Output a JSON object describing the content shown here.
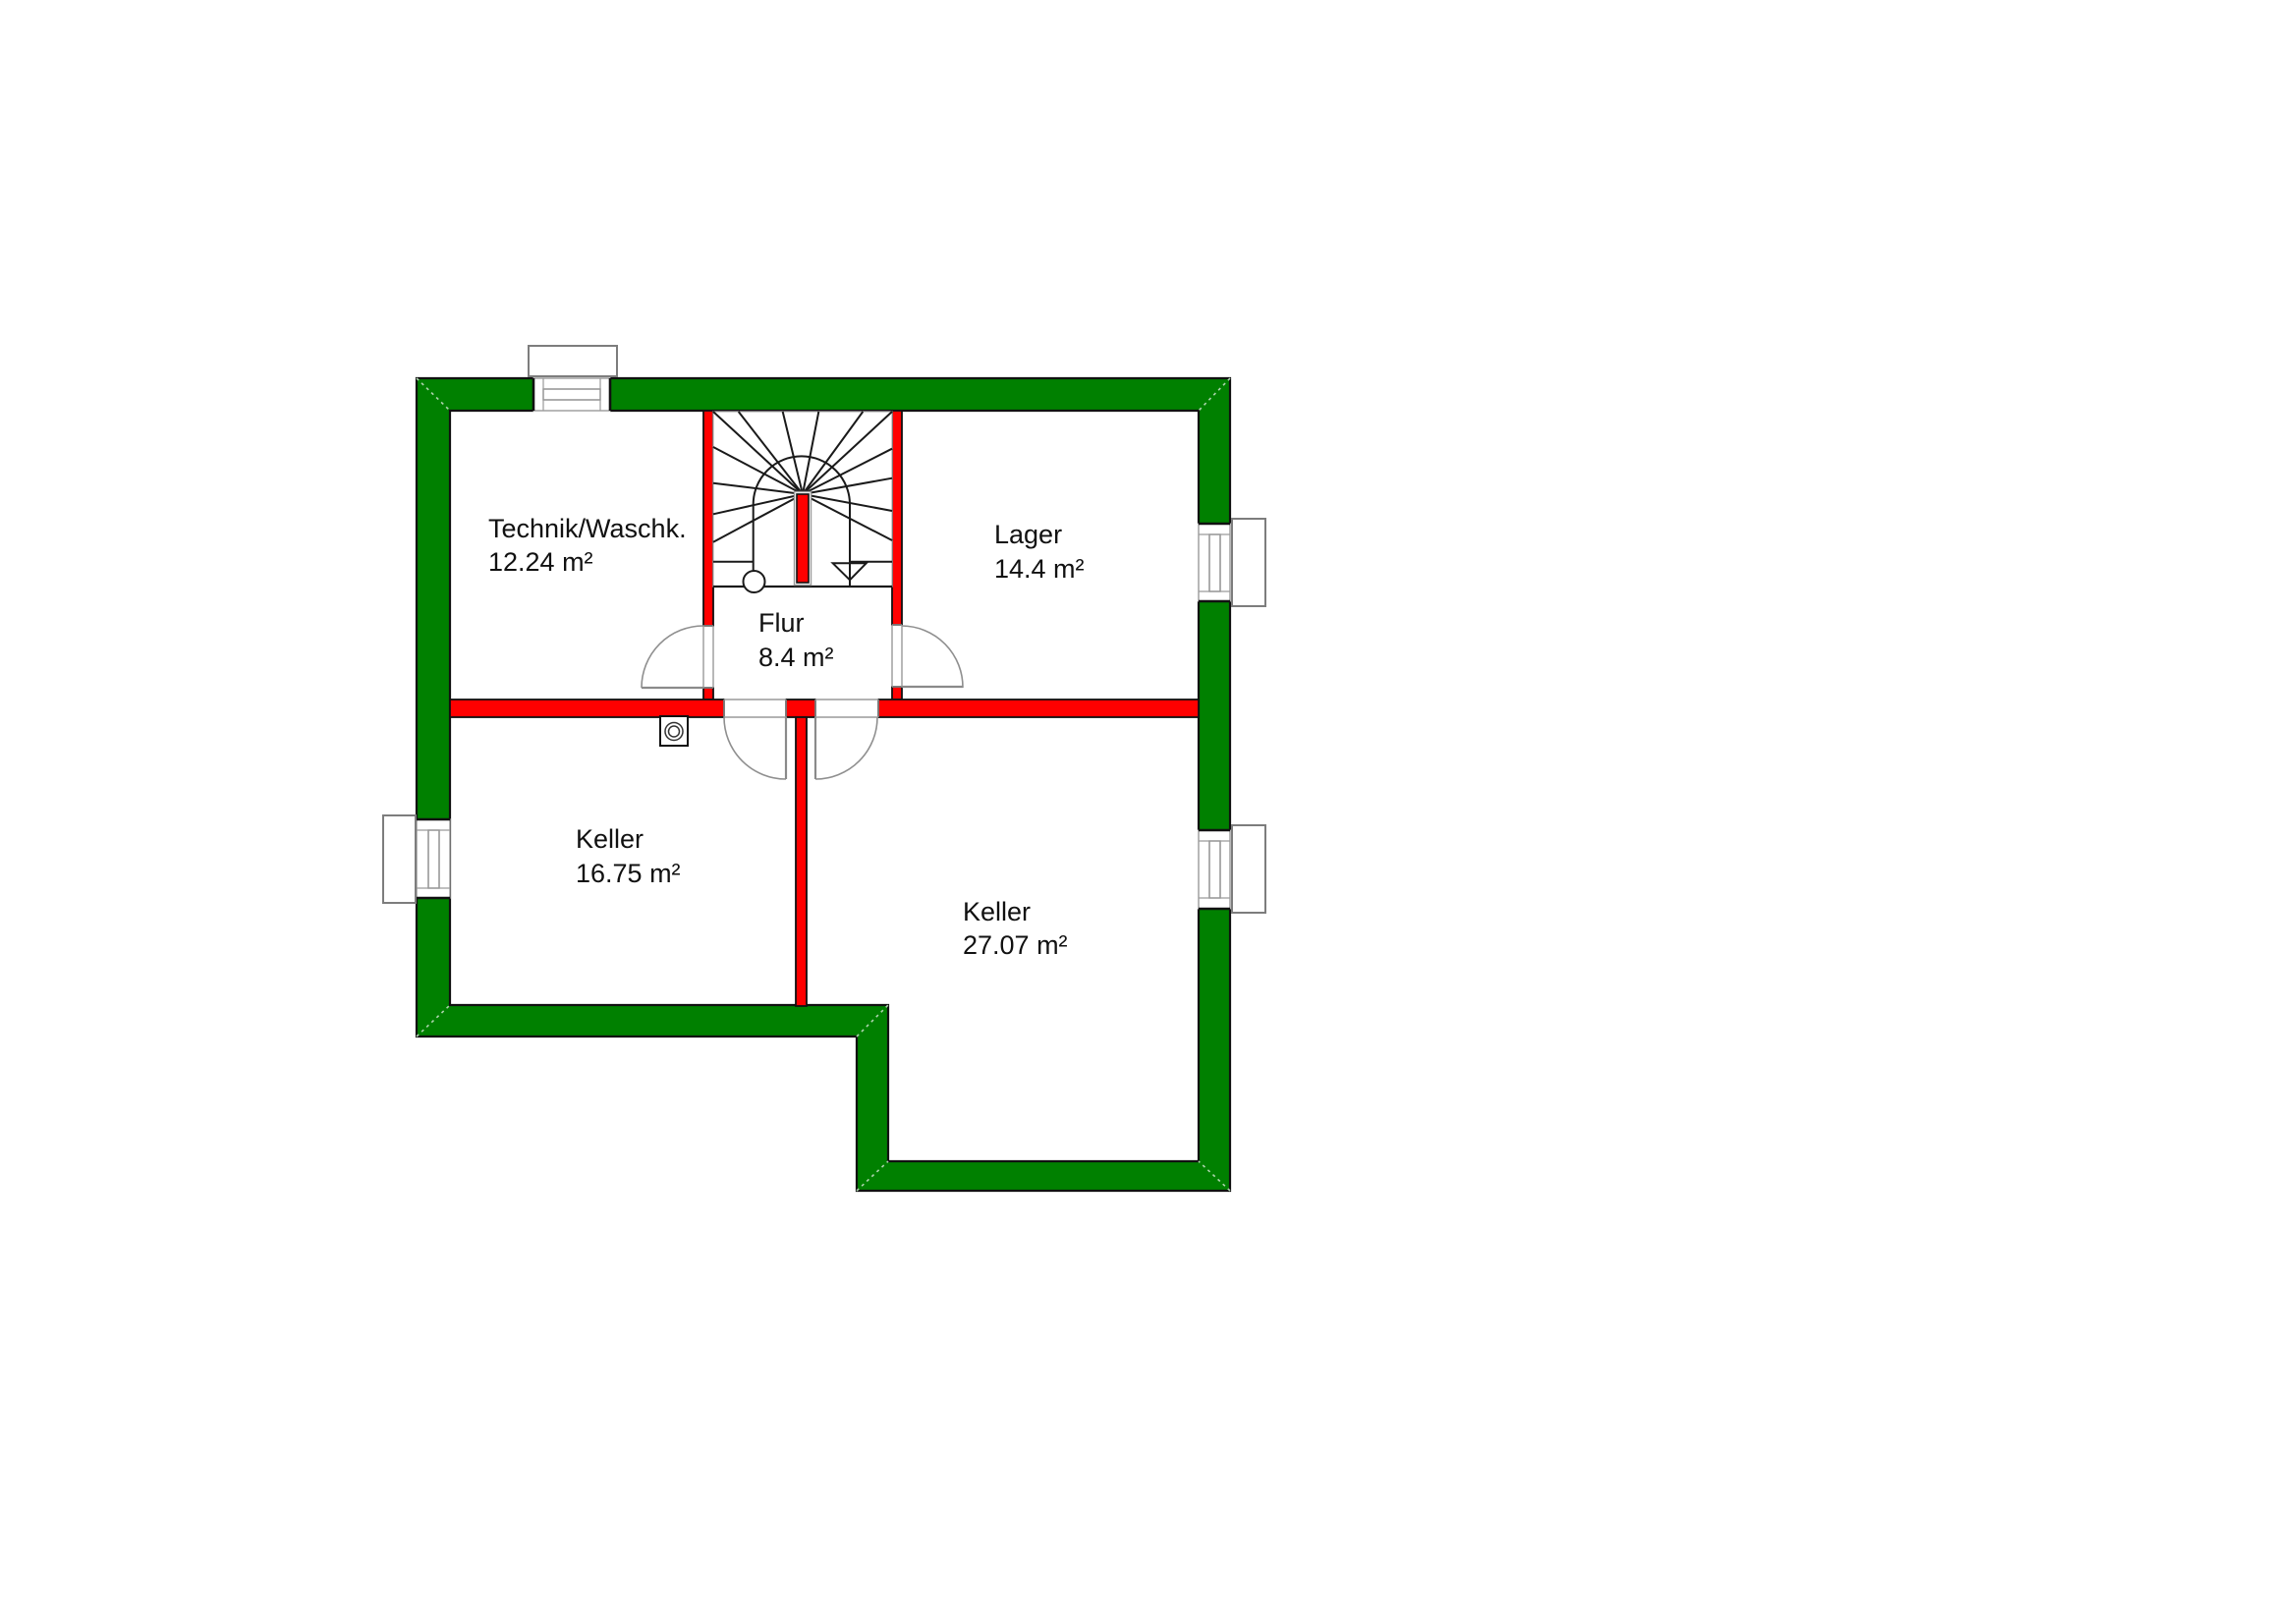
{
  "title": "Kellergeschoss Grundriss",
  "rooms": {
    "technik": {
      "name": "Technik/Waschk.",
      "area": "12.24 m²"
    },
    "lager": {
      "name": "Lager",
      "area": "14.4 m²"
    },
    "flur": {
      "name": "Flur",
      "area": "8.4 m²"
    },
    "keller_small": {
      "name": "Keller",
      "area": "16.75 m²"
    },
    "keller_large": {
      "name": "Keller",
      "area": "27.07 m²"
    }
  },
  "colors": {
    "exterior_wall": "#008000",
    "interior_wall": "#ff0000",
    "outline": "#111111",
    "frame_gray": "#8a8a8a",
    "swing_gray": "#777777"
  }
}
